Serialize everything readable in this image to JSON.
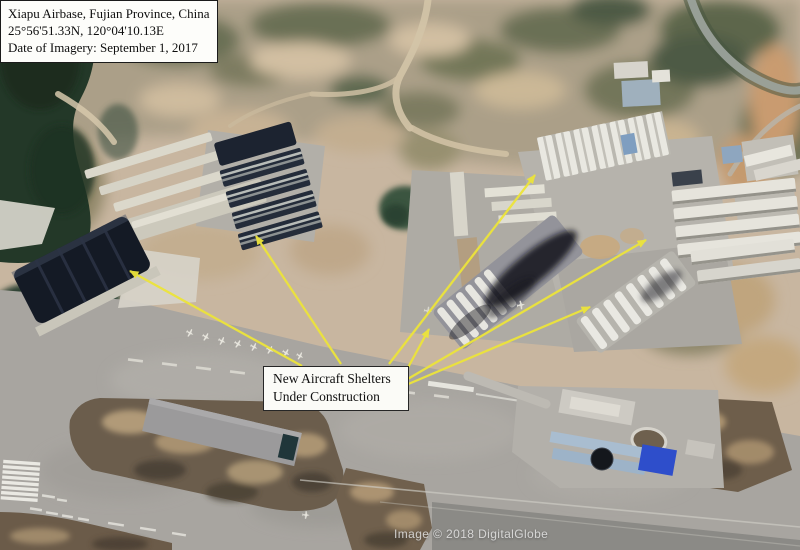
{
  "info_box": {
    "lines": [
      "Xiapu Airbase, Fujian Province, China",
      "25°56'51.33N, 120°04'10.13E",
      "Date of Imagery: September 1, 2017"
    ]
  },
  "annotation": {
    "label_lines": [
      "New Aircraft Shelters",
      "Under Construction"
    ],
    "arrow_color": "#ece43a",
    "arrow_count": 6
  },
  "watermark": "Image © 2018 DigitalGlobe",
  "colors": {
    "terrain_tan": "#c8b6a0",
    "vegetation_dark": "#233828",
    "concrete_grey": "#a8a5a0",
    "shelter_dark_roof": "#141a25",
    "callout_background": "#fbfbf7",
    "callout_border": "#262626"
  }
}
